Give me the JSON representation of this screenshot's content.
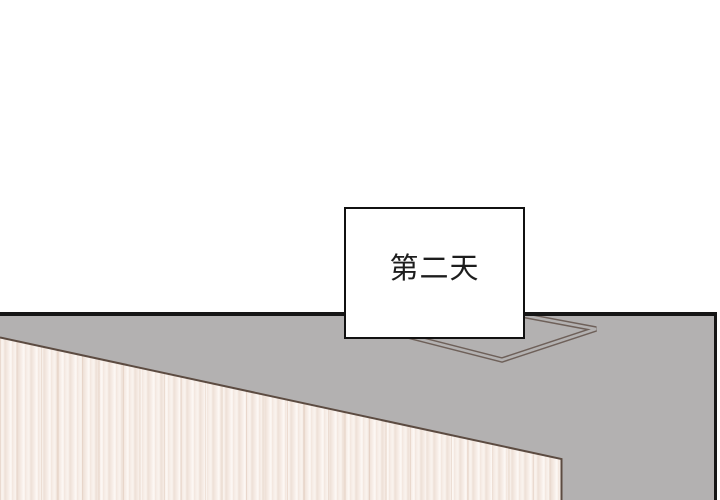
{
  "panel": {
    "kind": "comic-panel",
    "caption": {
      "text": "第二天"
    },
    "colors": {
      "background": "#ffffff",
      "surface_gray": "#b3b1b1",
      "outline_black": "#161616",
      "frame_line": "#6e6059",
      "wood_base": "#f5ebe4",
      "wood_edge_line": "#5c4b41",
      "caption_border": "#111111",
      "caption_text": "#1d1d1d"
    }
  }
}
